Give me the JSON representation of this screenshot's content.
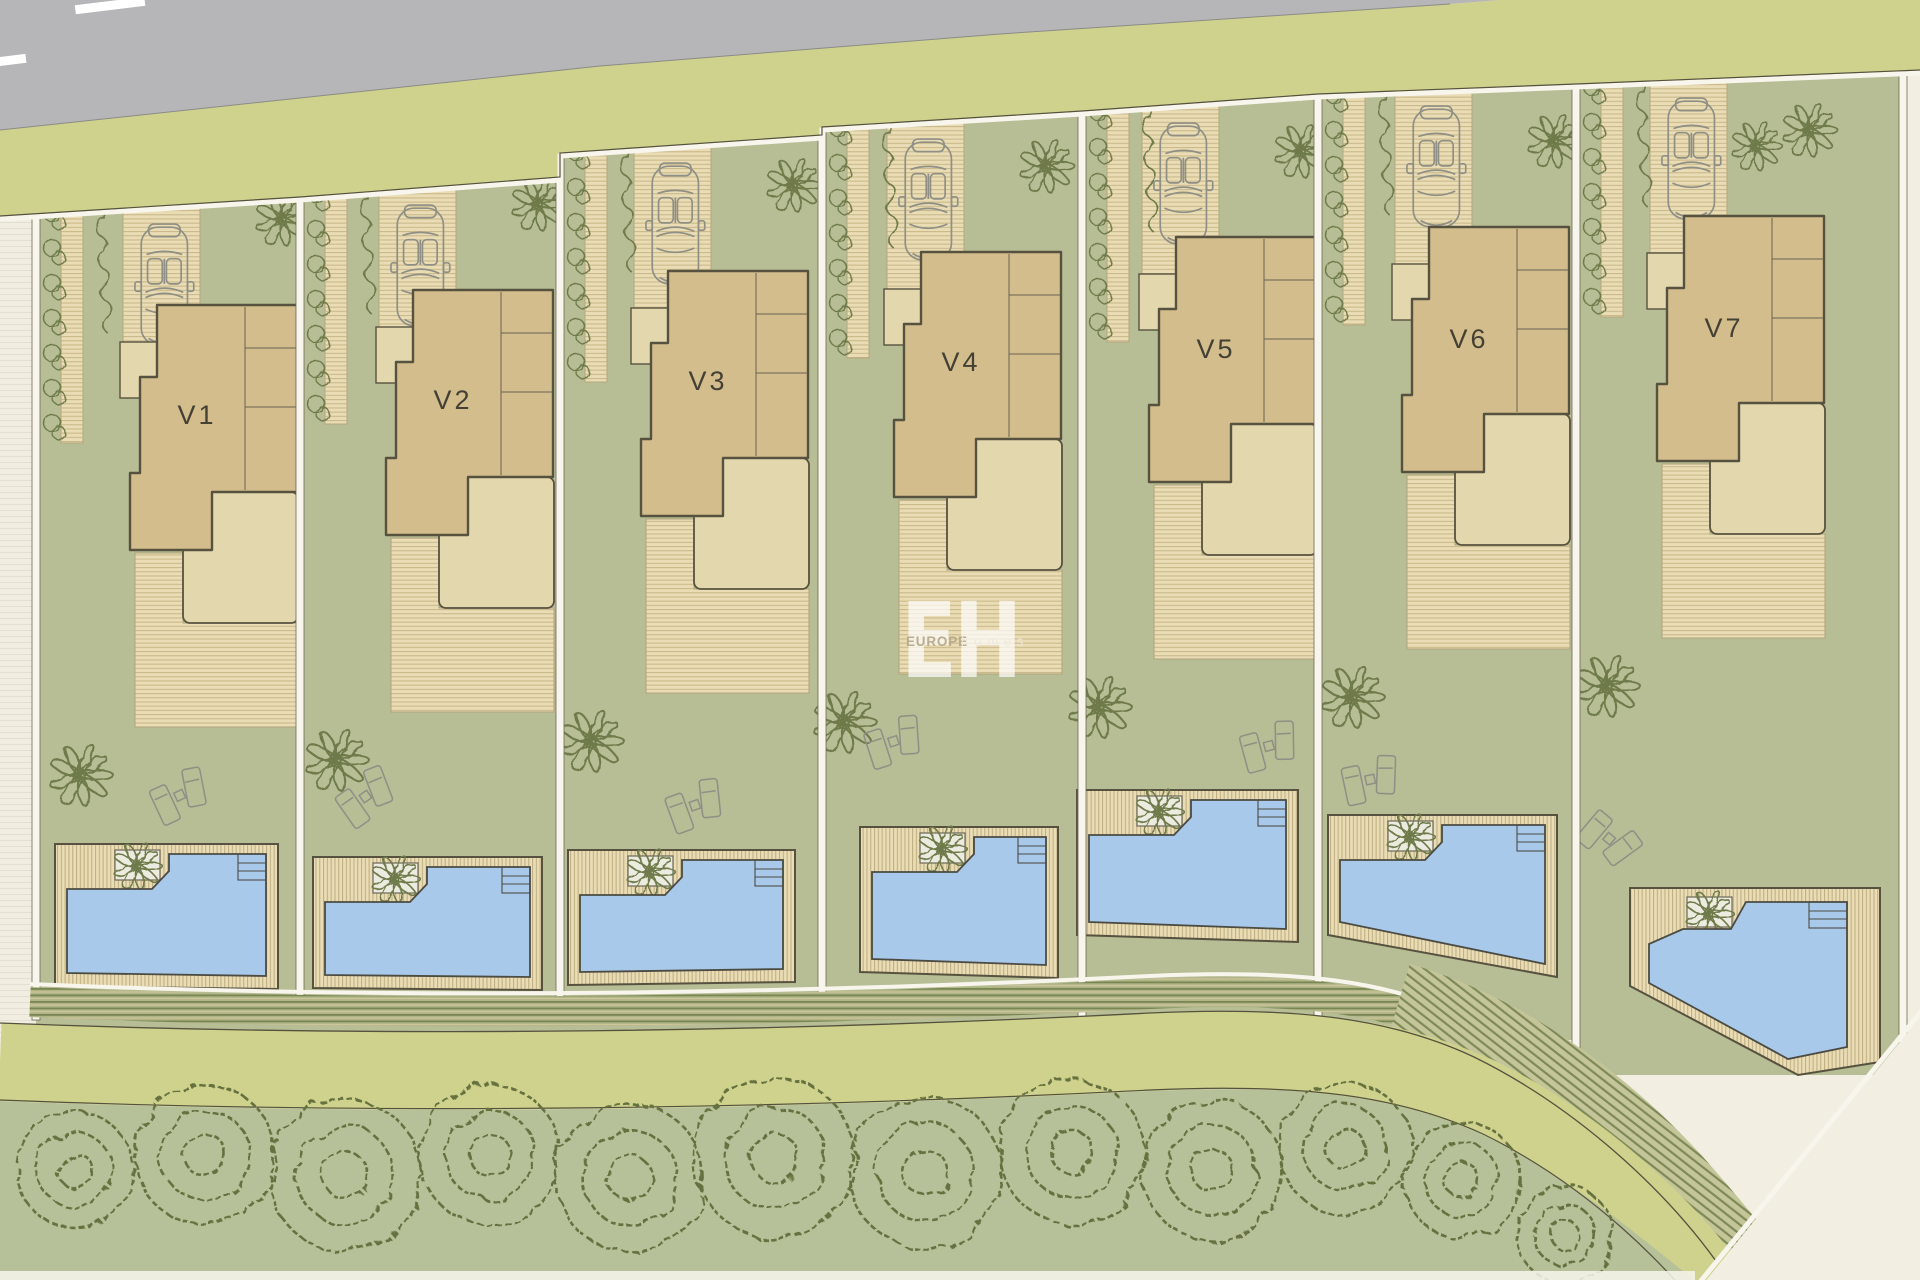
{
  "plan": {
    "villas": [
      {
        "label": "V1"
      },
      {
        "label": "V2"
      },
      {
        "label": "V3"
      },
      {
        "label": "V4"
      },
      {
        "label": "V5"
      },
      {
        "label": "V6"
      },
      {
        "label": "V7"
      }
    ],
    "watermark": {
      "initials": "EH",
      "brand": "EUROPE",
      "suffix": "homes"
    },
    "palette": {
      "cream": "#f2efe2",
      "road": "#b6b6b8",
      "verge": "#cfd28c",
      "lawn": "#b7bd94",
      "deck_bg": "#eaddb5",
      "deck_line": "#cab98b",
      "deck_line2": "#c0af83",
      "house": "#d3bd8c",
      "house_stroke": "#57523f",
      "terrace": "#e3d7ae",
      "pool": "#a9c9ea",
      "pool_stroke": "#4b4b42",
      "hedge": "#6e7a49",
      "tree": "#66713f",
      "treestrip": "#b7c199",
      "rows_bg": "#aeb687",
      "rows_dark": "#7a8552",
      "rows_light": "#cfc49a",
      "hatch_bg": "#c4c69a",
      "hatch_line": "#7f8957",
      "white": "#f7f5ec",
      "faint_bg": "#f1eee1",
      "faint_line": "#e3e0d1",
      "label": "#444134",
      "car": "#8f8f85",
      "planter": "#ecebdf",
      "wm_white": "#ffffff",
      "wm_beige": "#b7a98a"
    }
  }
}
